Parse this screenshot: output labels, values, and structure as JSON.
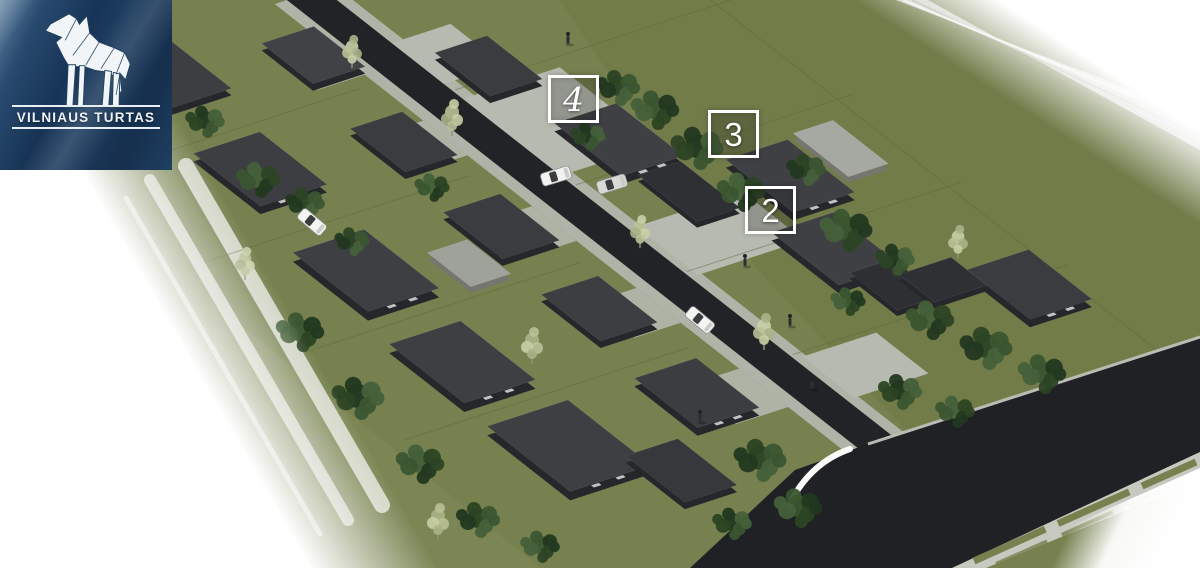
{
  "branding": {
    "name": "VILNIAUS TURTAS",
    "logo_icon": "wolf-origami-icon",
    "background_color": "#1d3a57",
    "text_color": "#eef3f7"
  },
  "plot_markers": [
    {
      "label": "4"
    },
    {
      "label": "3"
    },
    {
      "label": "2"
    }
  ],
  "palette": {
    "grass": "#76814f",
    "field_shade": "#6d7846",
    "asphalt": "#212327",
    "sidewalk": "#b7bab0",
    "house_roof": "#3e4044",
    "house_wall": "#26272b",
    "carport_roof": "#a6a8a2",
    "marker_border": "#ffffff",
    "shrub_green": "#2c4324"
  }
}
